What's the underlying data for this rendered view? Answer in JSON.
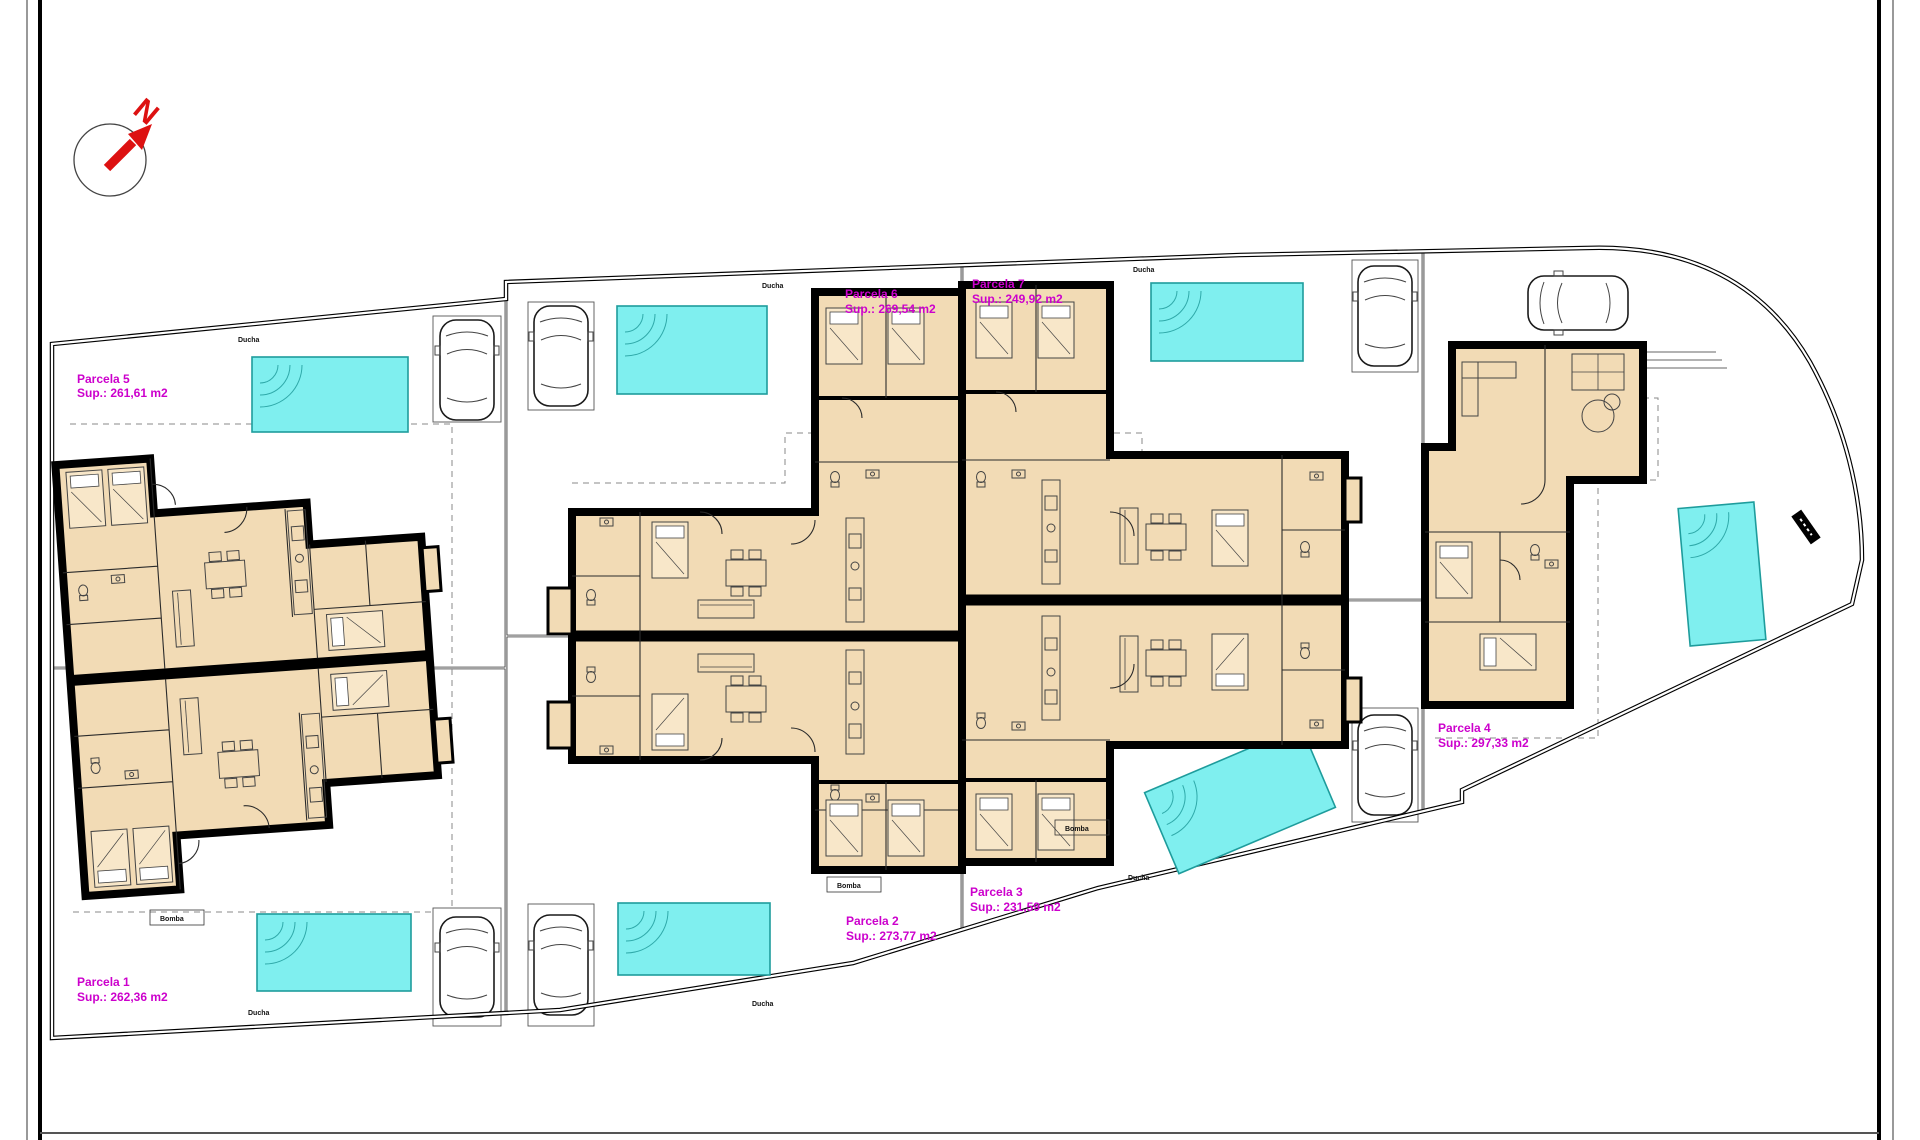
{
  "compass": {
    "north_label": "N"
  },
  "parcels": [
    {
      "name": "Parcela 1",
      "area": "Sup.: 262,36 m2"
    },
    {
      "name": "Parcela 2",
      "area": "Sup.: 273,77 m2"
    },
    {
      "name": "Parcela 3",
      "area": "Sup.: 231,59 m2"
    },
    {
      "name": "Parcela 4",
      "area": "Sup.: 297,33 m2"
    },
    {
      "name": "Parcela 5",
      "area": "Sup.: 261,61 m2"
    },
    {
      "name": "Parcela 6",
      "area": "Sup.: 269,54 m2"
    },
    {
      "name": "Parcela 7",
      "area": "Sup.: 249,92 m2"
    }
  ],
  "annotations": {
    "shower": "Ducha",
    "pump": "Bomba"
  },
  "colors": {
    "room_fill": "#F2DBB5",
    "pool_fill": "#7FEFEF",
    "pool_edge": "#1E9C9C",
    "parcel_label": "#CC00CC",
    "north_arrow": "#DD1111",
    "wall": "#000000"
  }
}
